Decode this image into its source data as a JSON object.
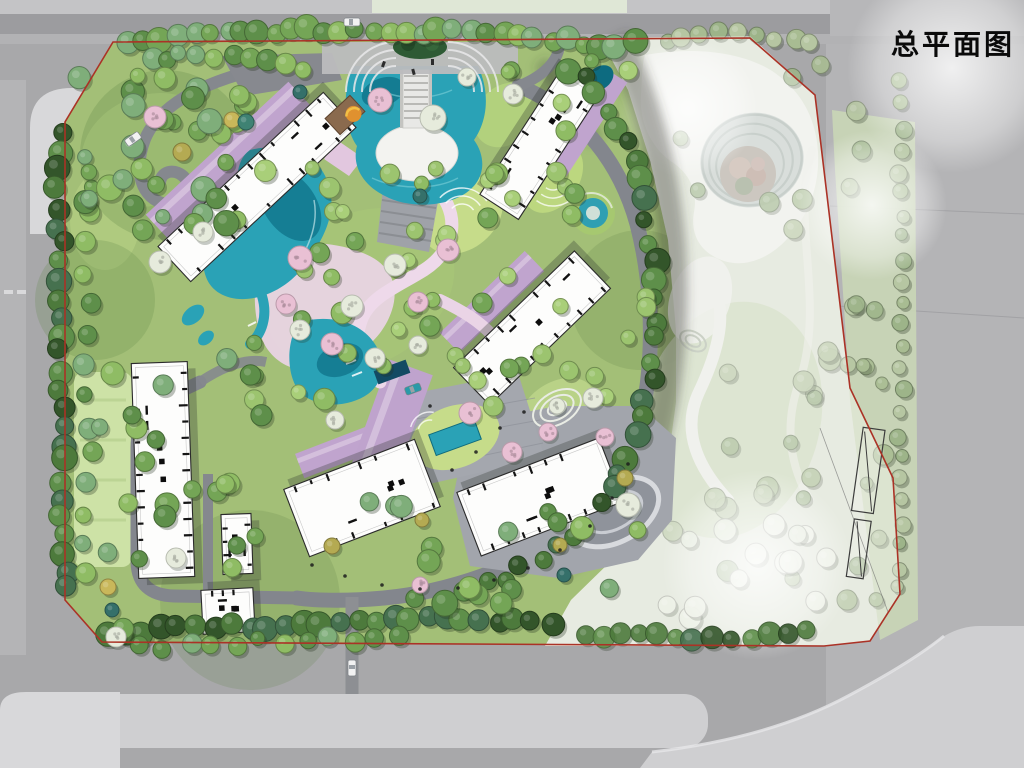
{
  "page": {
    "title": "总平面图"
  },
  "colors": {
    "title": "#0a0a0a",
    "road": "#a8a8aa",
    "road_light": "#b4b4b6",
    "road_internal": "#83868d",
    "sidewalk": "#cfcfd1",
    "sidewalk_bright": "#d8d8da",
    "mint_strip": "#dfe7d6",
    "site_green": "#a3bf77",
    "lawn": "#c9df99",
    "lawn_bright": "#c6dc8a",
    "park_base": "#dce1d2",
    "park_lawn": "#c9d6b6",
    "park_white": "#eceee8",
    "water": "#2aa2b6",
    "water_deep": "#10758c",
    "water_pond": "#0d6b80",
    "lavender": "#c0a4ce",
    "lavender_light": "#d8c5e0",
    "pink_path": "#eed9ea",
    "pink_blob": "#ead4e6",
    "building_fill": "#fdfdfc",
    "building_line": "#2b2b2b",
    "plaza_gray": "#a2a5ac",
    "court_gray": "#a4a7ae",
    "deck_gray": "#9fa2a8",
    "boundary_red": "#ab3226",
    "tree_dark": "#4d7a3c",
    "tree_mid": "#5e8f4a",
    "tree_bright": "#8fbc64",
    "tree_pale": "#a8bc92",
    "tree_sage": "#9db489",
    "blossom_pink": "#e9c0d4",
    "blossom_white": "#e6ebdc",
    "accent_yellow": "#b4aa52",
    "accent_teal": "#3f8273",
    "car_white": "#f2f2f2",
    "car_teal": "#2a9aa8"
  }
}
